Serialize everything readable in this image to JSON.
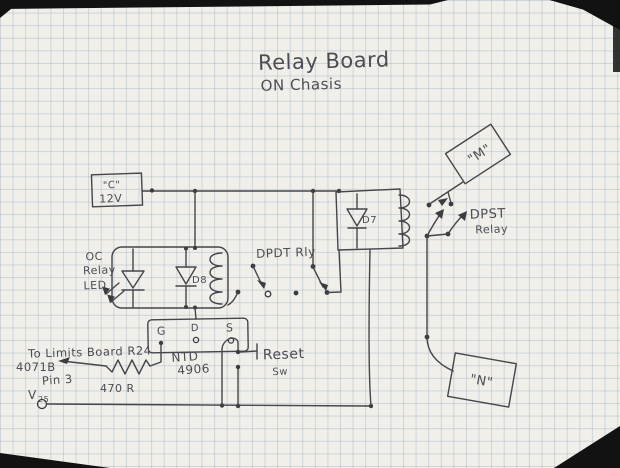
{
  "title": {
    "line1": "Relay Board",
    "line2": "ON Chasis"
  },
  "supply_box": {
    "name": "\"C\"",
    "voltage": "12V"
  },
  "led_note": {
    "line1": "OC",
    "line2": "Relay",
    "line3": "LED"
  },
  "diodes": {
    "d8": "D8",
    "d7": "D7"
  },
  "relays": {
    "dpdt_label": "DPDT Rly",
    "dpst_line1": "DPST",
    "dpst_line2": "Relay"
  },
  "mosfet": {
    "pin_g": "G",
    "pin_d": "D",
    "pin_s": "S",
    "part_line1": "NTD",
    "part_line2": "4906"
  },
  "reset_switch": {
    "line1": "Reset",
    "line2": "Sw"
  },
  "limits_note": {
    "line1": "To Limits Board R24",
    "line2": "4071B",
    "line3": "Pin 3"
  },
  "resistor": {
    "value": "470 R"
  },
  "terminal": {
    "v_main": "V",
    "v_sub": "25"
  },
  "connectors": {
    "m": "\"M\"",
    "n": "\"N\""
  },
  "colors": {
    "ink": "#45454a",
    "paper": "#f0efea",
    "grid": "#94aaba"
  }
}
